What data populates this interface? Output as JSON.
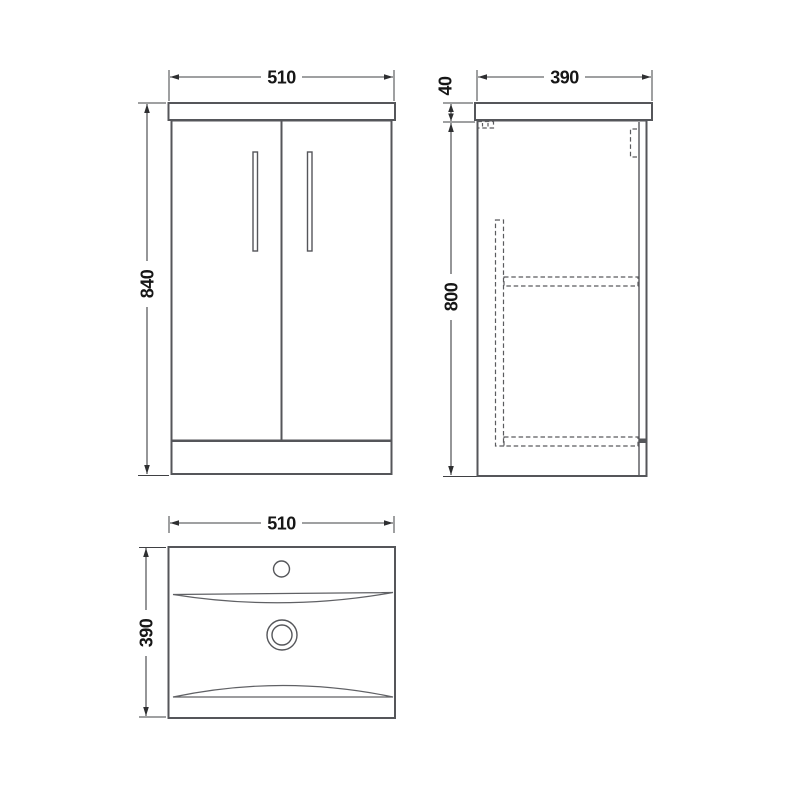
{
  "page": {
    "background": "#ffffff"
  },
  "drawing": {
    "colors": {
      "object_line": "#55565a",
      "hidden_line": "#5a5b5e",
      "dimension_line": "#3f4043",
      "text": "#161616"
    },
    "views": {
      "front": {
        "dimensions": {
          "width": {
            "value": 510,
            "label": "510"
          },
          "height": {
            "value": 840,
            "label": "840"
          }
        }
      },
      "side": {
        "dimensions": {
          "depth": {
            "value": 390,
            "label": "390"
          },
          "worktop_thickness": {
            "value": 40,
            "label": "40"
          },
          "cabinet_height": {
            "value": 800,
            "label": "800"
          }
        }
      },
      "plan": {
        "dimensions": {
          "width": {
            "value": 510,
            "label": "510"
          },
          "depth": {
            "value": 390,
            "label": "390"
          }
        }
      }
    }
  }
}
